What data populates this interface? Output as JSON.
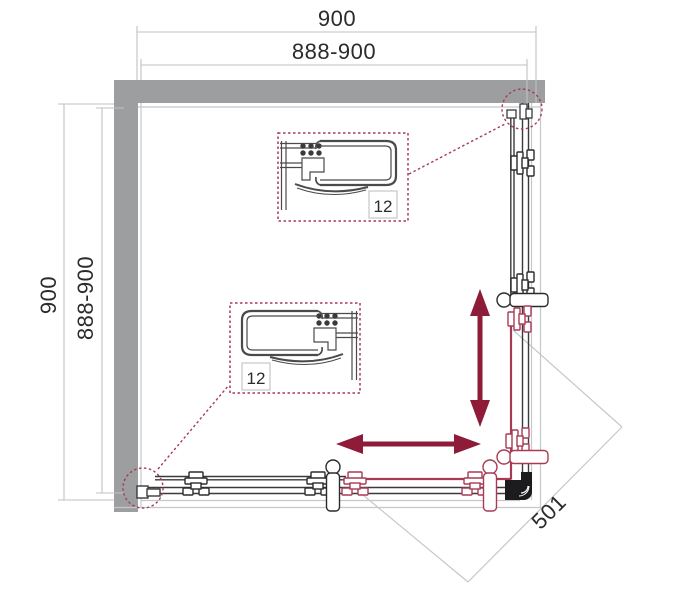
{
  "drawing": {
    "type": "shower-enclosure-top-view-technical-drawing",
    "dimensions": {
      "top_outer": "900",
      "top_inner": "888-900",
      "left_outer": "900",
      "left_inner": "888-900",
      "diagonal_entry": "501"
    },
    "callouts": {
      "detail_top_label": "12",
      "detail_bottom_label": "12"
    },
    "colors": {
      "wall_gray": "#9c9ea0",
      "line_dark": "#3a3a3c",
      "line_light": "#c5c7c9",
      "accent_magenta": "#a83a55",
      "arrow_red": "#8e1b38"
    }
  }
}
